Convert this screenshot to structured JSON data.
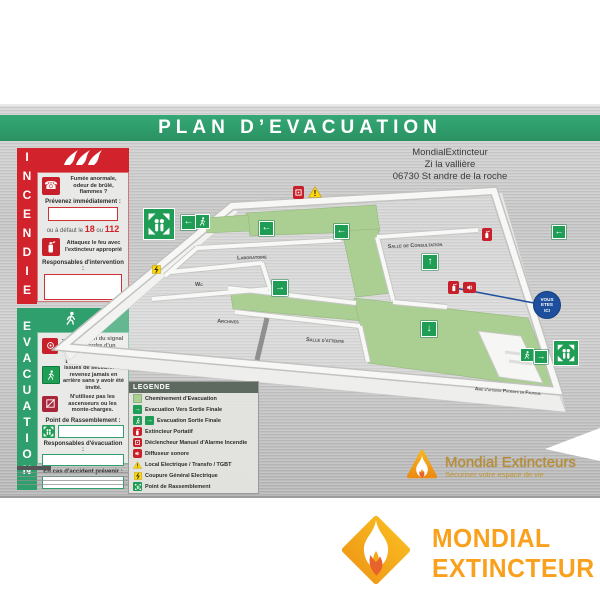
{
  "header": {
    "title": "PLAN D’EVACUATION"
  },
  "address": [
    "MondialExtincteur",
    "Zi la vallière",
    "06730 St andre de la roche"
  ],
  "incendie": {
    "title": "INCENDIE",
    "alert_text": "Fumée anormale, odeur de brûlé, flammes ?",
    "prevenez_label": "Prévenez immédiatement :",
    "fb_prefix": "ou à défaut le",
    "fb_n1": "18",
    "fb_or": "ou",
    "fb_n2": "112",
    "attack_text": "Attaquez le feu avec l'extincteur approprié",
    "responsables_label": "Responsables d'intervention :"
  },
  "evacuation": {
    "title": "EVACUATION",
    "step1": "... à l'audition du signal ou sur ordre d'un responsable.",
    "step2": "Dirigez-vous vers les issues de secours. Ne revenez jamais en arrière sans y avoir été invité.",
    "step3": "N'utilisez pas les ascenseurs ou les monte-charges.",
    "rassemblement_label": "Point de Rassemblement :",
    "responsables_label": "Responsables d'évacuation :",
    "accident_label": "En cas d'accident prévenir :"
  },
  "legend": {
    "title": "LEGENDE",
    "items": [
      {
        "icon": "path-swatch",
        "label": "Cheminement d'Evacuation"
      },
      {
        "icon": "exit-arrow",
        "label": "Evacuation Vers Sortie Finale"
      },
      {
        "icon": "exit-man-arrow",
        "label": "Evacuation Sortie Finale"
      },
      {
        "icon": "extinguisher",
        "label": "Extincteur Portatif"
      },
      {
        "icon": "manual-alarm",
        "label": "Déclencheur Manuel d'Alarme Incendie"
      },
      {
        "icon": "sounder",
        "label": "Diffuseur sonore"
      },
      {
        "icon": "warning-triangle",
        "label": "Local Electrique / Transfo / TGBT"
      },
      {
        "icon": "power-cut",
        "label": "Coupure Général Electrique"
      },
      {
        "icon": "assembly-point",
        "label": "Point de Rassemblement"
      }
    ]
  },
  "plan": {
    "rooms": [
      "Laboratoire",
      "Wc",
      "Archives",
      "Salle de Consultation",
      "Salle d'attente",
      "Aire d'attente Patients en Fauteuil"
    ],
    "yah": {
      "l1": "VOUS",
      "l2": "ETES",
      "l3": "ICI"
    }
  },
  "icons": {
    "left": "←",
    "right": "→",
    "up": "↑",
    "down": "↓",
    "warn": "!"
  },
  "panel_logo": {
    "name": "Mondial Extincteurs",
    "tagline": "Sécuriser votre espace de vie"
  },
  "footer_logo": {
    "line1": "MONDIAL",
    "line2": "EXTINCTEUR"
  },
  "colors": {
    "header_green": "#2f9f6d",
    "incendie_red": "#c8202a",
    "evacuation_green": "#2f9f6d",
    "plan_path_green": "#abce92",
    "icon_green": "#1f9d55",
    "you_are_here_blue": "#1e4f9c",
    "logo_orange": "#f9a11d",
    "warning_yellow": "#ffd60a"
  }
}
